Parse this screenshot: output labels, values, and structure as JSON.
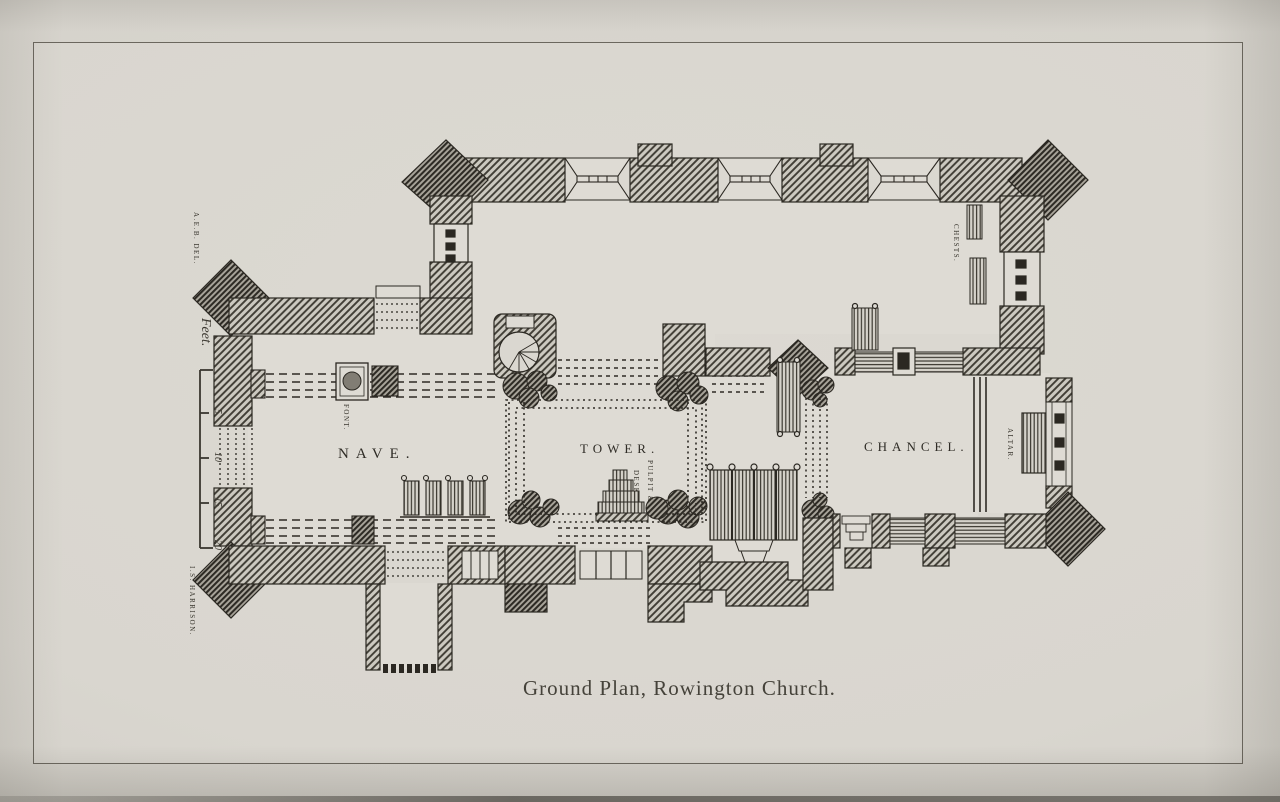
{
  "page": {
    "caption": "Ground Plan, Rowington Church.",
    "credit_delineator": "A.E.B. DEL.",
    "credit_engraver": "I.S. HARRISON."
  },
  "scale": {
    "title": "Feet.",
    "ticks": [
      "5",
      "10",
      "15",
      "20"
    ]
  },
  "rooms": {
    "nave": "NAVE.",
    "tower": "TOWER.",
    "chancel": "CHANCEL."
  },
  "furnishings": {
    "altar": "ALTAR.",
    "chests": "CHESTS.",
    "font": "FONT.",
    "pulpit_line1": "PULPIT &",
    "pulpit_line2": "DESK"
  }
}
